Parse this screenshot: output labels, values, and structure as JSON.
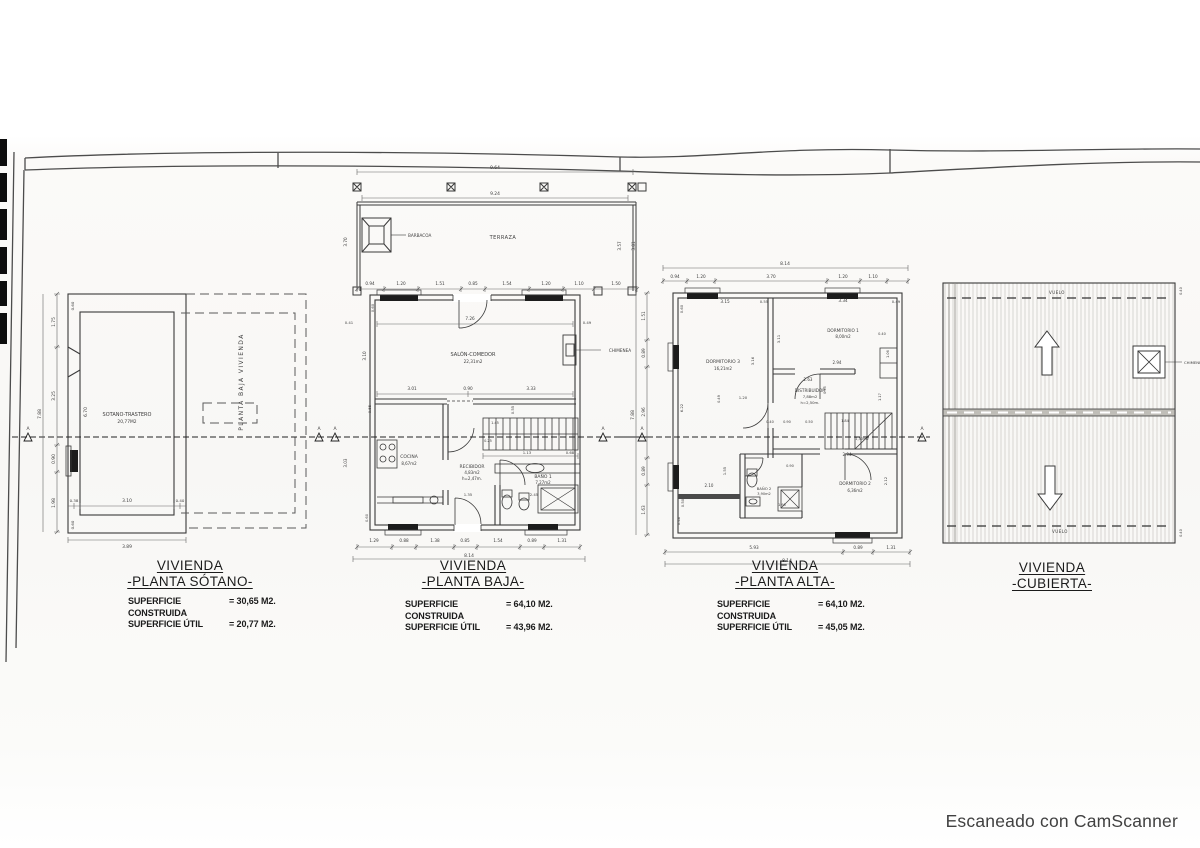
{
  "footer": {
    "camscanner": "Escaneado con CamScanner"
  },
  "section": {
    "marker": "A"
  },
  "sotano": {
    "title1": "VIVIENDA",
    "title2": "-PLANTA SÓTANO-",
    "sc_label": "SUPERFICIE CONSTRUIDA",
    "sc_value": "= 30,65 M2.",
    "su_label": "SUPERFICIE ÚTIL",
    "su_value": "= 20,77 M2.",
    "room_name": "SOTANO-TRASTERO",
    "room_area": "20,77M2",
    "overlay": "PLANTA BAJA VIVIENDA",
    "dims": {
      "left_total": "7.88",
      "left": [
        "1.75",
        "3.25",
        "0.90",
        "1.98"
      ],
      "wall_top": "0.60",
      "inner_h": "6.70",
      "bottom_inner": [
        "0.38",
        "3.10",
        "0.40"
      ],
      "wall_bottom": "0.60",
      "bottom_total": "3.89"
    }
  },
  "baja": {
    "title1": "VIVIENDA",
    "title2": "-PLANTA BAJA-",
    "sc_label": "SUPERFICIE CONSTRUIDA",
    "sc_value": "= 64,10 M2.",
    "su_label": "SUPERFICIE ÚTIL",
    "su_value": "= 43,96 M2.",
    "labels": {
      "barbacoa": "BARBACOA",
      "terraza": "TERRAZA",
      "salon1": "SALÓN-COMEDOR",
      "salon2": "22,31m2",
      "chimenea": "CHIMENEA",
      "cocina1": "COCINA",
      "cocina2": "8,67m2",
      "recibidor1": "RECIBIDOR",
      "recibidor2": "4,83m2",
      "recibidor3": "h=2,47m.",
      "bano1a": "BAÑO 1",
      "bano1b": "7,27m2"
    },
    "dims": {
      "top1": "9.64",
      "top2": "9.24",
      "terraza_left": "3.70",
      "terraza_right1": "3.57",
      "terraza_right2": "3.81",
      "row": [
        "0.94",
        "1.20",
        "1.51",
        "0.85",
        "1.54",
        "1.20",
        "1.10",
        "1.50"
      ],
      "salon_left": "0.41",
      "salon_right": "0.49",
      "salon_w": "7.26",
      "salon_h": "3.10",
      "wall_top": "0.60",
      "salon_bottom": [
        "3.01",
        "0.90",
        "3.33"
      ],
      "small1": "0.55",
      "small2": "0.55",
      "cocina_h": "3.03",
      "wall_bottom": "0.60",
      "stairs": [
        "1.45",
        "0.25",
        "1.13",
        "0.68"
      ],
      "recibidor_w": "1.35",
      "bano_w": "2.45",
      "bottom": [
        "1.29",
        "0.88",
        "1.38",
        "0.85",
        "1.54",
        "0.89",
        "1.31"
      ],
      "bottom_total": "8.14"
    }
  },
  "alta": {
    "title1": "VIVIENDA",
    "title2": "-PLANTA ALTA-",
    "sc_label": "SUPERFICIE CONSTRUIDA",
    "sc_value": "= 64,10 M2.",
    "su_label": "SUPERFICIE ÚTIL",
    "su_value": "= 45,05 M2.",
    "labels": {
      "dorm3a": "DORMITORIO 3",
      "dorm3b": "16,21m2",
      "dorm1a": "DORMITORIO 1",
      "dorm1b": "8,00m2",
      "distra": "DISTRIBUIDOR",
      "distrb": "7,88m2",
      "distrc": "h=2,50m.",
      "bano2a": "BAÑO 2",
      "bano2b": "3,90m2",
      "dorm2a": "DORMITORIO 2",
      "dorm2b": "6,36m2",
      "stairs_area": "1,50m2"
    },
    "dims": {
      "top_total": "8.14",
      "top_row": [
        "0.94",
        "1.20",
        "3.70",
        "1.20",
        "1.10"
      ],
      "left_total": "7.88",
      "left": [
        "1.51",
        "0.89",
        "2.96",
        "0.89",
        "1.63"
      ],
      "left_inner": [
        "0.60",
        "6.22",
        "0.50",
        "0.46"
      ],
      "interior": [
        "3.15",
        "0.55",
        "3.34",
        "0.49",
        "3.11",
        "3.16",
        "2.94",
        "2.63",
        "1.20",
        "0.40",
        "0.90",
        "0.50",
        "1.84",
        "1.06",
        "1.17",
        "0.95",
        "2.94",
        "2.12",
        "1.55",
        "2.10",
        "1.95",
        "0.90",
        "0.40",
        "0.49"
      ],
      "bottom": [
        "5.93",
        "0.89",
        "1.31"
      ],
      "bottom_total": "8.14"
    }
  },
  "cubierta": {
    "title1": "VIVIENDA",
    "title2": "-CUBIERTA-",
    "labels": {
      "vuelo_top": "VUELO",
      "vuelo_bottom": "VUELO",
      "chimenea": "CHIMENEA"
    },
    "dims": {
      "right_top": "0.40",
      "right_bottom": "0.40"
    }
  }
}
